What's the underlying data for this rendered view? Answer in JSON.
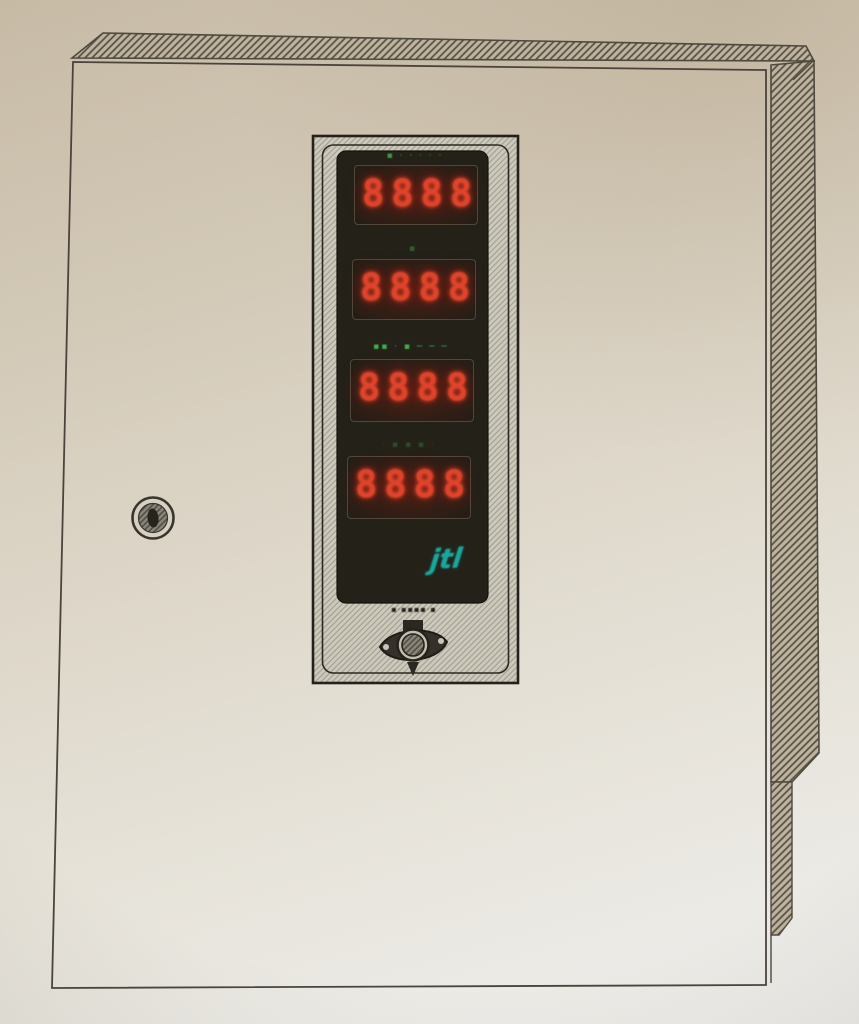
{
  "device": {
    "panel": {
      "displays": [
        {
          "indicator": "▪ · · · · ·",
          "value": "8888"
        },
        {
          "indicator": "▪",
          "value": "8888"
        },
        {
          "indicator": "▪▪ · ▪  ─ ─ ─",
          "value": "8888"
        },
        {
          "indicator": "· ▪ ▪ ▪ ·",
          "value": "8888"
        }
      ],
      "logo_text": "jtl",
      "emblem_text": "▪·▪▪▪▪·▪"
    },
    "colors": {
      "digit_red": "#e0432c",
      "indicator_green": "#3fae4e",
      "logo_teal": "#17a79c",
      "window_black": "#242119",
      "plate_gray": "#cdcabd",
      "paper_top": "#c7bba6",
      "paper_bottom": "#edece9",
      "line_ink": "#4f4a40"
    }
  }
}
